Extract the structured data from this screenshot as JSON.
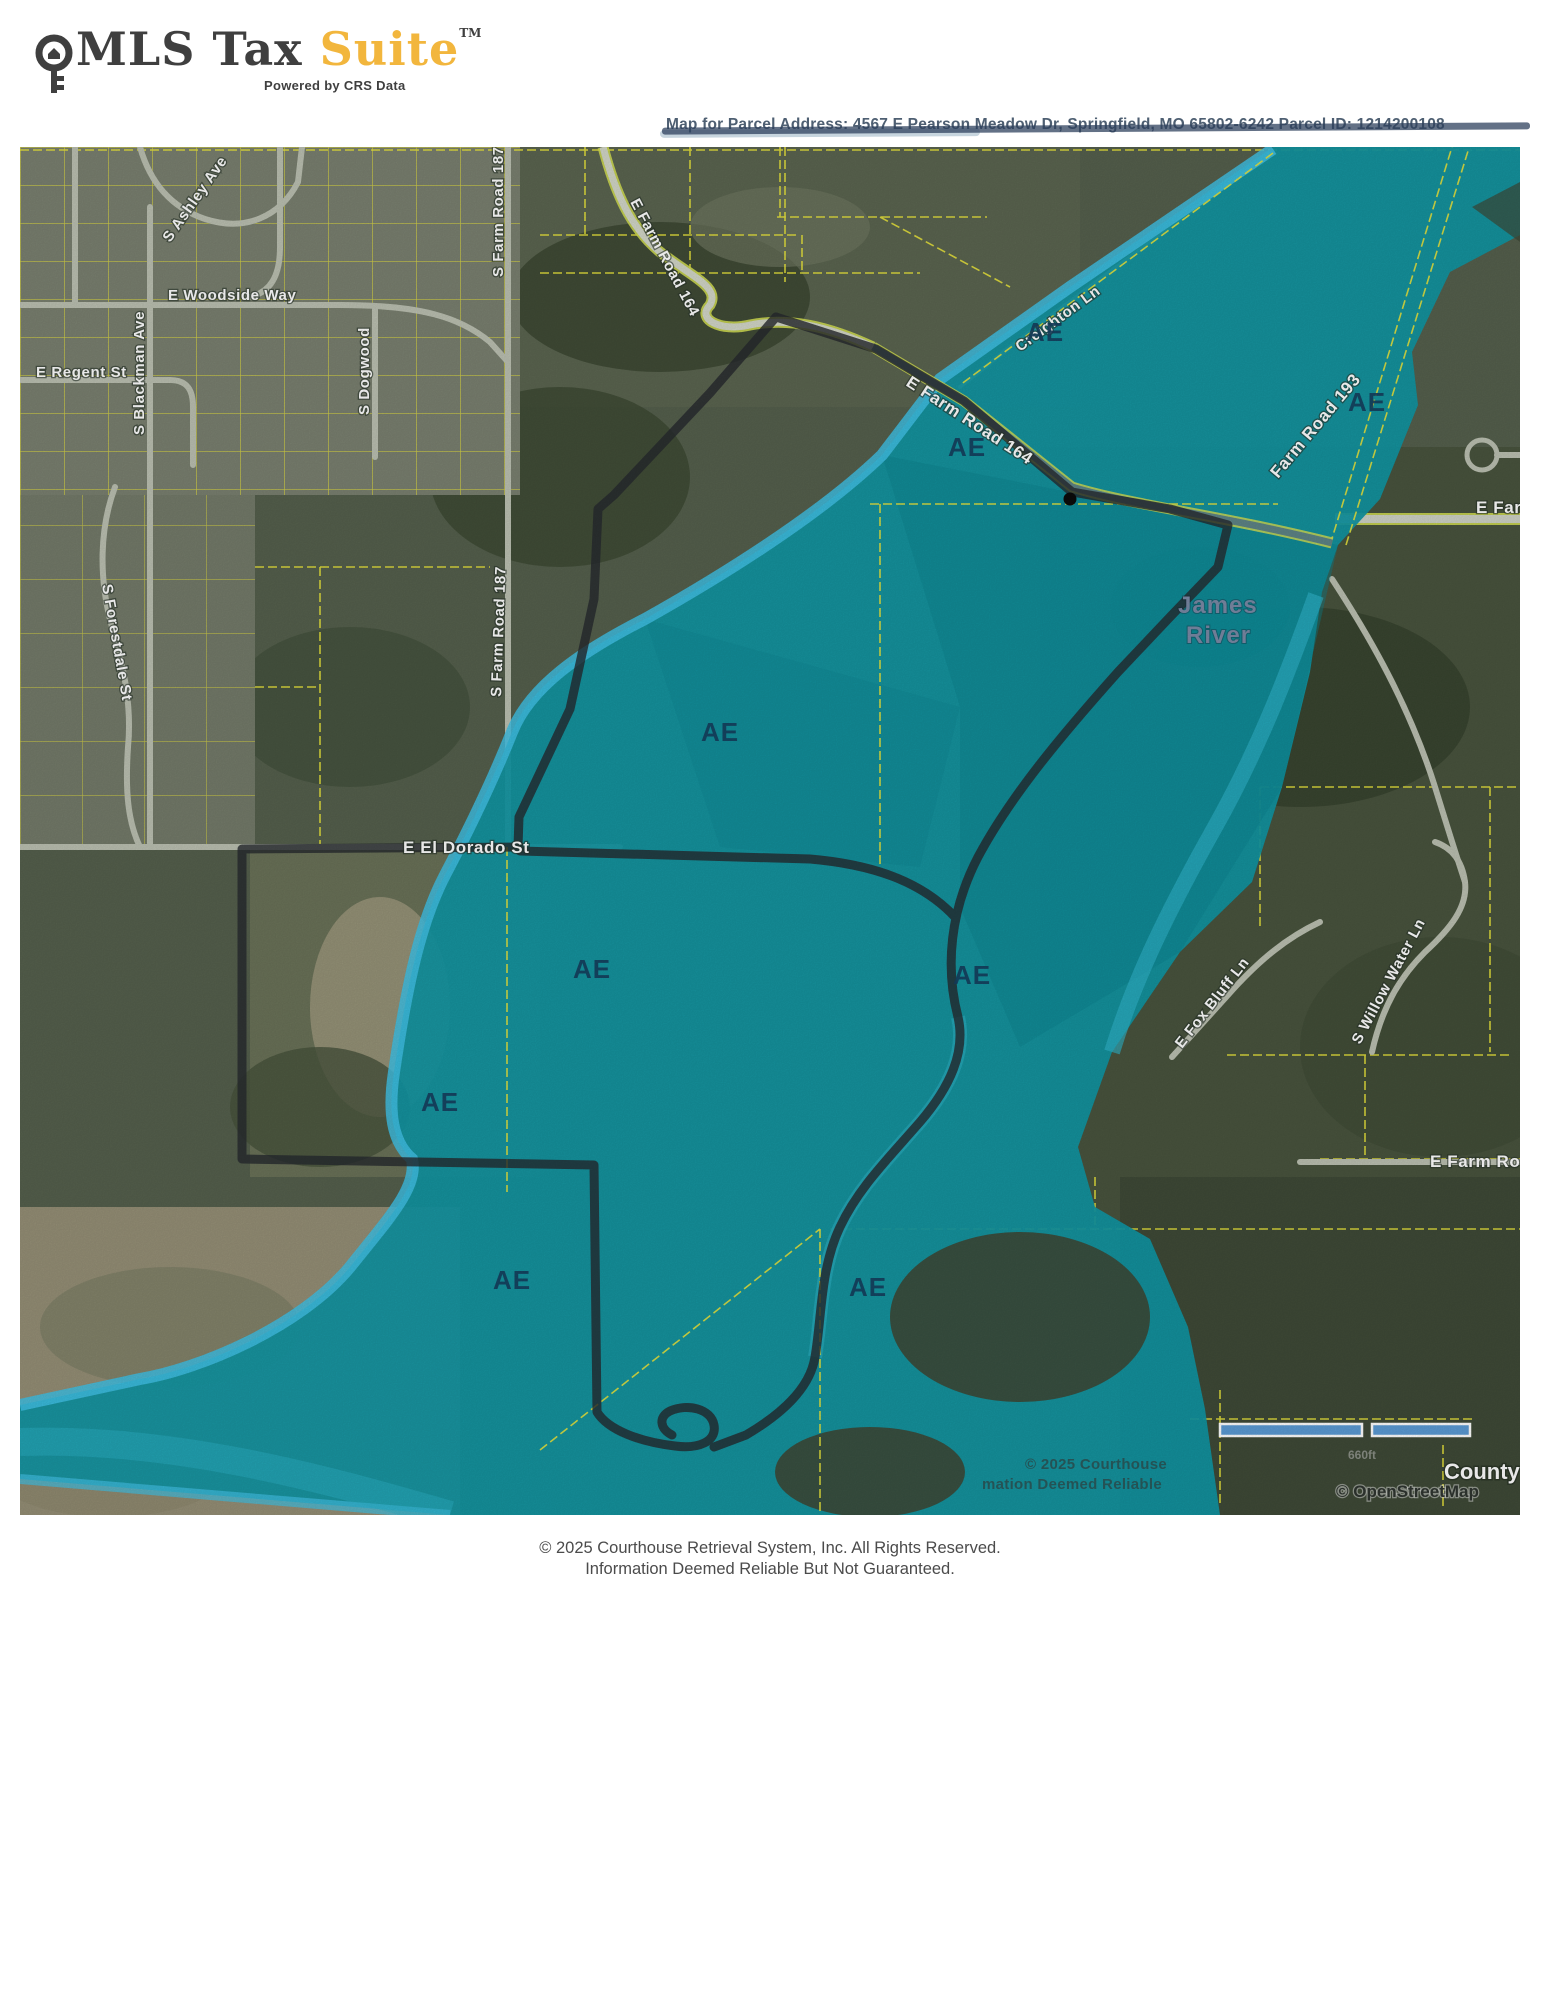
{
  "header": {
    "brand_primary": "MLS Tax",
    "brand_accent": "Suite",
    "trademark": "TM",
    "tagline": "Powered by CRS Data"
  },
  "parcel_banner": {
    "text": "Map for Parcel Address: 4567 E Pearson Meadow Dr, Springfield, MO 65802-6242 Parcel ID: 1214200108"
  },
  "map": {
    "flood_zone_label": "AE",
    "river_name_line1": "James",
    "river_name_line2": "River",
    "streets": {
      "e_farm_road_164": "E Farm Road 164",
      "creighton_ln": "Creighton Ln",
      "farm_road_193": "Farm Road 193",
      "e_far_truncated": "E Far",
      "e_woodside_way": "E Woodside Way",
      "e_regent_st": "E Regent St",
      "s_ashley_ave": "S Ashley Ave",
      "s_blackman_ave": "S Blackman Ave",
      "s_dogwood": "S Dogwood",
      "s_farm_road_187": "S Farm Road 187",
      "s_forestdale_st": "S Forestdale St",
      "e_el_dorado_st": "E El Dorado St",
      "e_fox_bluff_ln": "E Fox Bluff Ln",
      "s_willow_water_ln": "S Willow Water Ln",
      "e_farm_ro_truncated": "E Farm Ro"
    },
    "county_label": "County",
    "watermark_line1": "© 2025 Courthouse",
    "watermark_line2": "mation Deemed Reliable",
    "scale_label": "660ft",
    "osm_attribution": "© OpenStreetMap"
  },
  "footer": {
    "line1": "© 2025 Courthouse Retrieval System, Inc. All Rights Reserved.",
    "line2": "Information Deemed Reliable But Not Guaranteed."
  },
  "colors": {
    "flood_zone_fill": "#1196a4",
    "flood_zone_edge": "#41c2e6",
    "zone_label_text": "#16405f",
    "parcel_lines": "#e8e33c",
    "subject_boundary": "#26292e",
    "brand_accent": "#f2b63d",
    "brand_text": "#3f3f3f",
    "scale_bar_fill": "#5b9bd5"
  }
}
